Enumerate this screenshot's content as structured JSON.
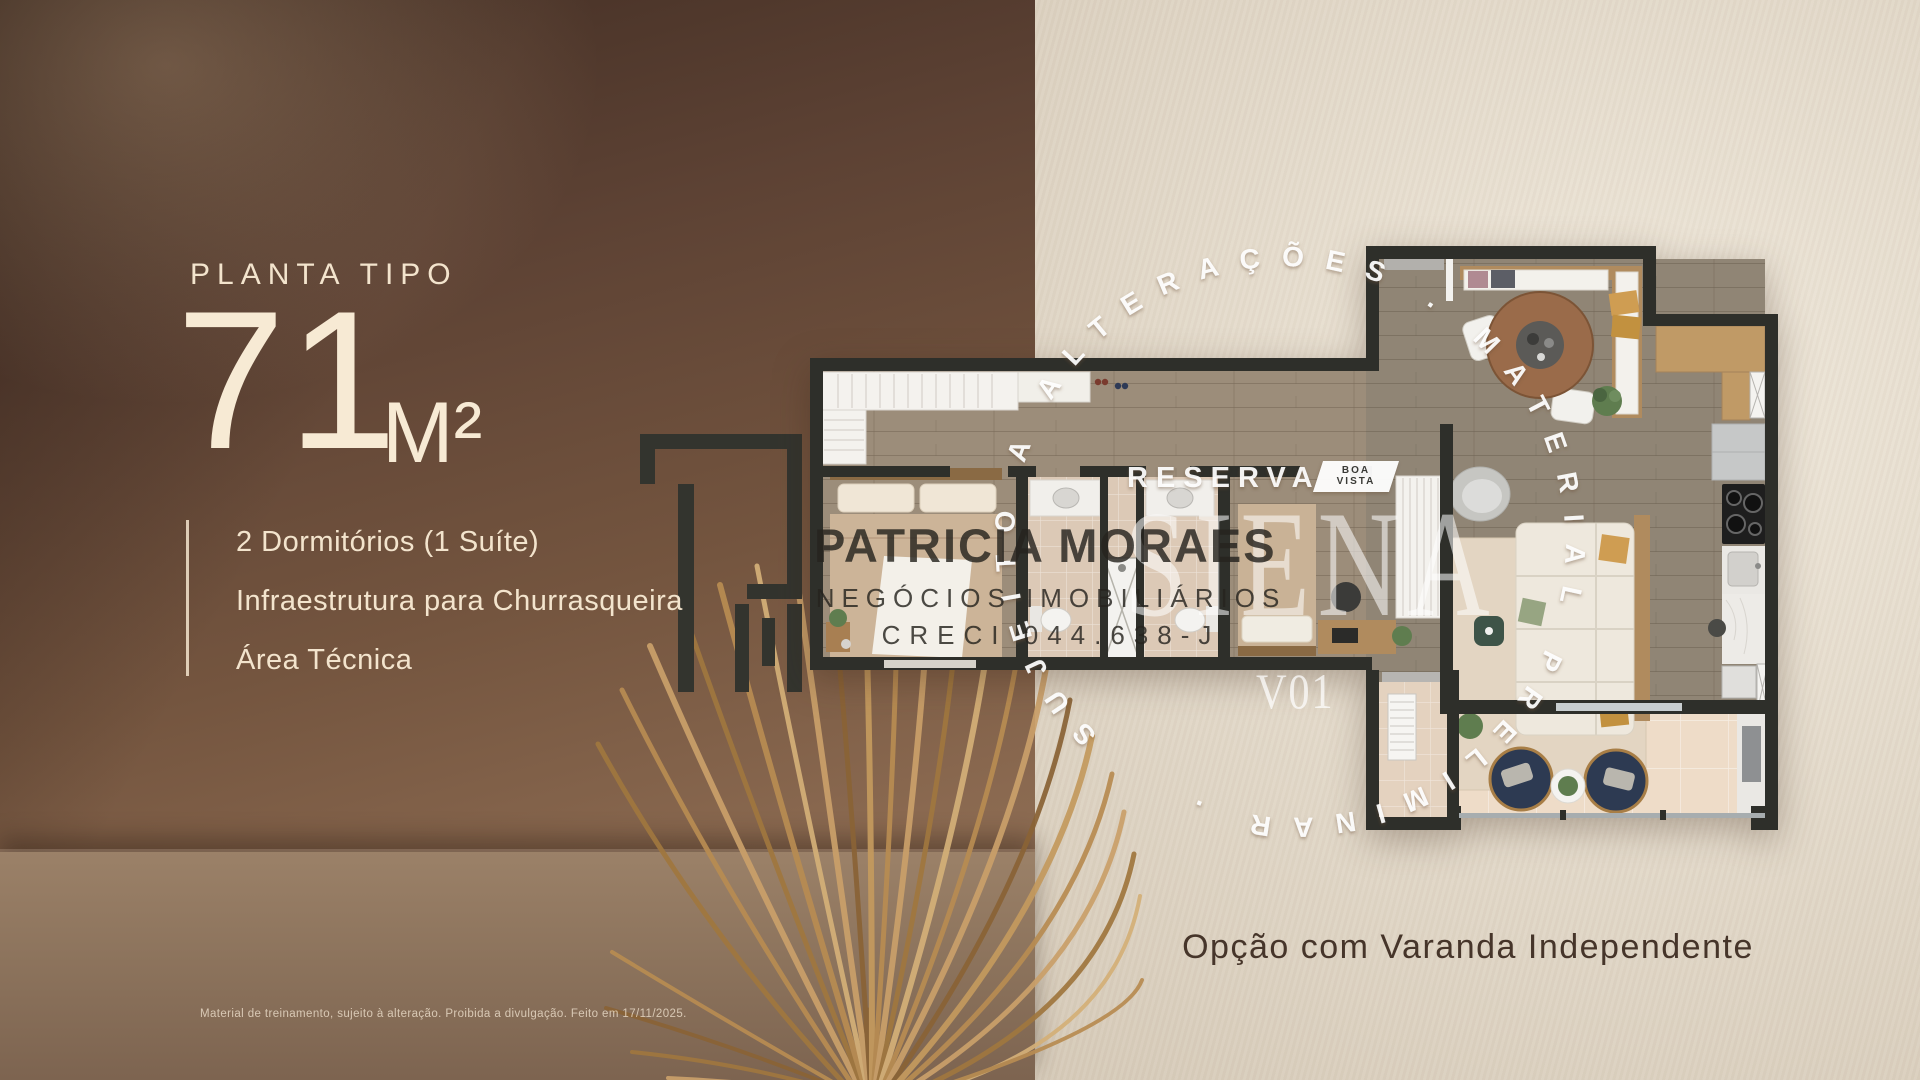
{
  "panel": {
    "eyebrow": "PLANTA TIPO",
    "area_value": "71",
    "area_unit": "M²",
    "features": [
      "2 Dormitórios (1 Suíte)",
      "Infraestrutura para Churrasqueira",
      "Área Técnica"
    ],
    "disclaimer": "Material de treinamento, sujeito à alteração. Proibida a divulgação. Feito em 17/11/2025."
  },
  "watermarks": {
    "broker_name": "PATRICIA MORAES",
    "broker_line2": "NEGÓCIOS IMOBILIÁRIOS",
    "broker_creci": "CRECI 044.638-J",
    "development_name": "RESERVA",
    "badge_lines": [
      "BOA",
      "VISTA"
    ],
    "tower_name": "SIENA",
    "plan_version": "V01",
    "ring_text": "SUJEITO A ALTERAÇÕES . MATERIAL PRELIMINAR ."
  },
  "caption": {
    "text": "Opção com Varanda Independente"
  },
  "icons": {
    "logo_monogram": "pm-geometric-monogram",
    "palm_leaf": "dried-palm-frond"
  },
  "colors": {
    "cream_text": "#f3e4cd",
    "brown_wall": "#6b4d3d",
    "linen_bg": "#e9e0d1",
    "caption_text": "#46352a",
    "navy_chair": "#2d3a52",
    "wall_dark": "#2e2f2a"
  }
}
